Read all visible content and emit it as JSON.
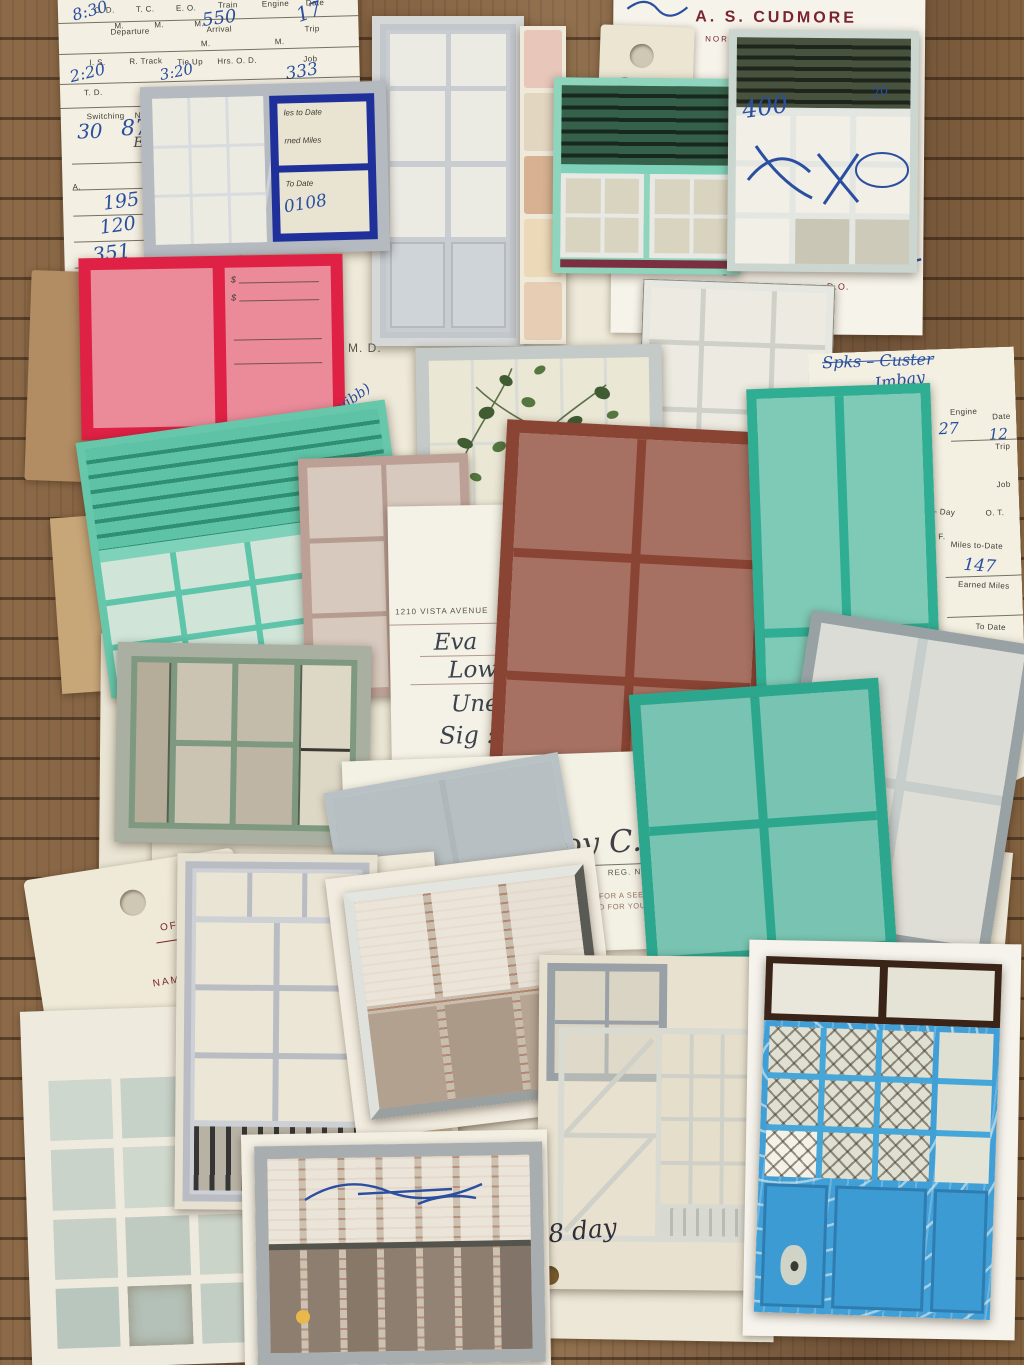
{
  "colors": {
    "wood": "#85653f",
    "paper_cream": "#f1ecdd",
    "paper_white": "#f6f3ea",
    "kraft": "#b18b61",
    "teal_frame": "#2fae94",
    "mint_frame": "#7fd2ba",
    "sage_frame": "#7e997f",
    "red_frame": "#df2145",
    "navy_frame": "#20309a",
    "rust_frame": "#8a4434",
    "blue_door": "#3f9fd6",
    "dark_shutter_green": "#24483a",
    "ink_blue": "#2b4fa0",
    "letterhead_maroon": "#7a2430",
    "stamp_red": "#d0493a"
  },
  "form_topleft": {
    "od": "O. D.",
    "tc": "T. C.",
    "eo": "E. O.",
    "train": "Train",
    "engine": "Engine",
    "date": "Date",
    "m1": "M.",
    "m2": "M.",
    "m3": "M.",
    "m4": "M.",
    "m5": "M.",
    "hw_od": "8:30",
    "hw_train": "550",
    "hw_date": "17",
    "departure": "Departure",
    "arrival": "Arrival",
    "trip": "Trip",
    "is": "I. S.",
    "rtrack": "R. Track",
    "tieup": "Tie Up",
    "hrs_od": "Hrs. O. D.",
    "job": "Job",
    "hw_is": "2:20",
    "hw_tieup": "3:20",
    "hw_job": "333",
    "td": "T. D.",
    "switching": "Switching",
    "no_car": "No. Car",
    "hw_sw1": "30",
    "hw_sw2": "87",
    "engr": "Engr",
    "a": "A.",
    "hw_n1": "195",
    "hw_n2": "120",
    "hw_n3": "351",
    "hw_n4": "17—",
    "hw_n5": "21",
    "dollar": "$"
  },
  "window_navy": {
    "frag1": "les to Date",
    "frag2": "rned Miles",
    "frag3": "To Date",
    "hw": "0108"
  },
  "letterhead": {
    "name": "A. S. CUDMORE",
    "street": "NORTH ELEVENTH STREET",
    "city": "BOISE,",
    "do": "D.O.",
    "frag1": "ILMENT, IT",
    "frag2": "AT THIS",
    "hw_400": "400",
    "hw_20": "20"
  },
  "tag_top": {
    "hw_a": "a"
  },
  "red_window": {
    "sig": "A. E. Hibbard",
    "md": "M. D.",
    "d1": "$",
    "d2": "$"
  },
  "prescription": {
    "doctor": "ROY C. CROSBY, M.D.",
    "specialty": "INTERNAL MEDICINE",
    "phones": "PHONES: OFFICE",
    "address": "1210 VISTA AVENUE",
    "city": "BOISE, IDAHO",
    "date_label": "DATE",
    "hw_date": "9/19/50",
    "age_label": "AGE",
    "hw_name": "Eva",
    "hw_name2": "Lowman",
    "hw_rx": "Uned",
    "hw_sig": "Sig : i  qi",
    "hw_sig2": "p.c. + H.S.",
    "stamp": "220633"
  },
  "form_right": {
    "hw_top1": "Spks – Custer",
    "hw_top2": "Imbay",
    "od": "O. D.",
    "tc": "T. C.",
    "eo": "E. O.",
    "train": "Train",
    "engine": "Engine",
    "date": "Date",
    "hw_train": "27",
    "hw_date": "12",
    "arrival": "Arrival",
    "trip": "Trip",
    "m1": "M.",
    "m2": "M.",
    "rtrack": "R. Track",
    "tieup": "Tie Up",
    "hw_tieup": "12:10",
    "hrs": "Hrs. O",
    "job": "Job",
    "td": "T. D.",
    "hw_td": "45",
    "haht": "H. A. H. T.",
    "miles_day": "Miles — Day",
    "switching": "Switching",
    "no_cars": "No. Cars",
    "rate": "Rate",
    "e1": "E.",
    "e2": "E.",
    "f": "F.",
    "ot": "O. T.",
    "miles_to_date": "Miles to-Date",
    "hw_miles": "147",
    "earned_miles": "Earned Miles",
    "engr": "Engr. or Frmn.",
    "condr": "Condr.",
    "hw_condr": "Newman",
    "tps": "T. P.'s",
    "hw_tps": "722",
    "to_date": "To Date",
    "hw_todate": "$ 130 10",
    "amount": "Amount",
    "hw_amt1": "26 41",
    "hw_amt2": "46 51",
    "expenses": "Expenses Awa",
    "room": "Room",
    "home": "m Home",
    "meals": "Meals",
    "d1": "$",
    "d2": "$",
    "d3": "$",
    "d4": "$"
  },
  "rx_bottom": {
    "refill": "REFILL ONLY",
    "boxes": "1 ☐   2 ☐   3 ☐   TIM",
    "prn": "P.R.N. ☐      NON REP ☐",
    "refilled": "REFILLED",
    "signature": "Roy C. Crosby",
    "reg": "REG. No. 0759",
    "md": "M.D.",
    "warning1": "NEVER OFFER THIS PRESCRIPTION TO A FRIEND FOR A SEEMINGLY SIMILAR AILMENT. IT",
    "warning2": "IS YOUR PERSONAL PRESCRIPTION, PREPARED FOR YOUR SPECIFIC ILLNESS AT THIS",
    "warning3": "TIME"
  },
  "tag_bottom": {
    "office": "OFFICE",
    "name": "NAME",
    "address": "ADDRESS",
    "letter": "R",
    "hw_mark": "1"
  },
  "barred_window": {
    "frag_md": "M.D.",
    "frag1": "GLAR AILMENT, IT",
    "frag2": "AT THIS"
  },
  "blue_door_sheet": {
    "number": "O. 3555",
    "hw_k": "K",
    "hw_red": "8"
  },
  "handwriting": {
    "squibb": "(Squibb)",
    "st_tab": "st Tab",
    "nal": "nal",
    "paul": "Paul",
    "sig2": "Sig : 2",
    "w": "W",
    "eight_day": "8 day",
    "md_center": "M. D.",
    "reg_n": "REG. N"
  }
}
